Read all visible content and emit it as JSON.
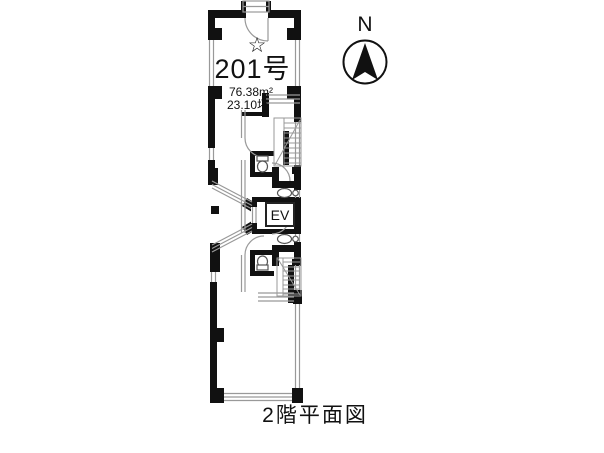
{
  "unit": {
    "star": "☆",
    "number": "201号",
    "area_m2": "76.38m²",
    "area_tsubo": "23.10坪"
  },
  "elevator": {
    "label": "EV"
  },
  "compass": {
    "label": "N"
  },
  "caption": {
    "text": "2階平面図"
  },
  "colors": {
    "wall": "#111111",
    "thin_line": "#999999",
    "fixture_line": "#555555",
    "background": "#ffffff"
  }
}
